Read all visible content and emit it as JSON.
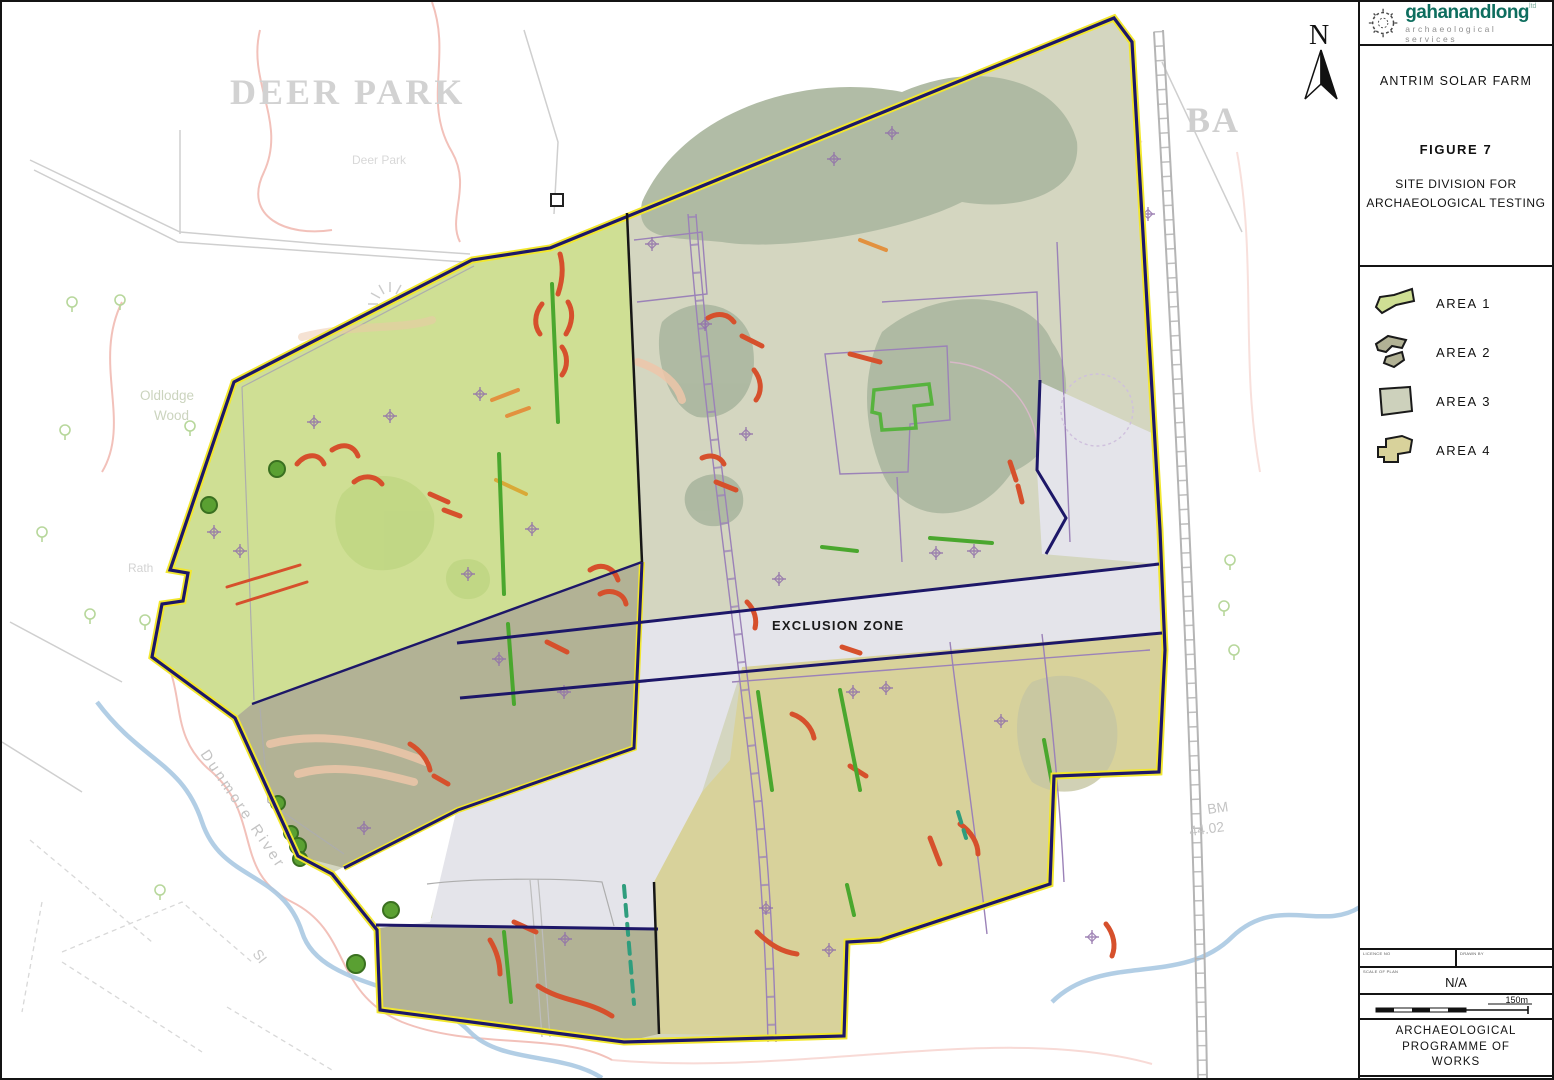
{
  "panel": {
    "logo": {
      "brand_a": "gahanand",
      "brand_b": "long",
      "brand_sup": "ltd",
      "tagline": "archaeological services"
    },
    "project_title": "ANTRIM SOLAR FARM",
    "figure_label": "FIGURE 7",
    "figure_subtitle_line1": "SITE DIVISION FOR",
    "figure_subtitle_line2": "ARCHAEOLOGICAL TESTING",
    "legend": {
      "items": [
        {
          "label": "AREA 1",
          "color": "#cfdf94"
        },
        {
          "label": "AREA 2",
          "color": "#b2b295"
        },
        {
          "label": "AREA 3",
          "color": "#cdd1bc"
        },
        {
          "label": "AREA 4",
          "color": "#d8d29b"
        }
      ]
    },
    "titleblock": {
      "cell1_label": "LICENCE NO",
      "cell2_label": "DRAWN BY",
      "cell3_label": "SCALE OF PLAN",
      "cell3_value": "N/A",
      "scale_label": "150m",
      "programme_line1": "ARCHAEOLOGICAL PROGRAMME OF",
      "programme_line2": "WORKS"
    }
  },
  "map": {
    "north_label": "N",
    "exclusion_zone_label": "EXCLUSION ZONE",
    "labels": {
      "deer_park_display": "DEER PARK",
      "deer_park_small": "Deer Park",
      "rath_north": "Rath",
      "oldlodge_line1": "Oldlodge",
      "oldlodge_line2": "Wood",
      "rath_west": "Rath",
      "dunmore_river": "Dunmore River",
      "si": "SI",
      "townland_east": "BA",
      "benchmark_line1": "BM",
      "benchmark_line2": "44.02"
    },
    "colors": {
      "area1": "#cfdf94",
      "area2": "#b2b295",
      "area3": "#d4d6c0",
      "area3_patch": "#adb8a1",
      "area4": "#d8d29b",
      "exclusion": "#e4e4ea",
      "boundary_navy": "#1d1768",
      "boundary_yellow": "#f2e72e",
      "anomaly_red": "#d6502c",
      "anomaly_orange": "#e2913f",
      "anomaly_salmon": "#edc6a9",
      "anomaly_green": "#4aa72e",
      "anomaly_teal": "#2f9d7d",
      "cross_purple": "#9272aa",
      "parcel_purple": "#9b82b8"
    }
  }
}
